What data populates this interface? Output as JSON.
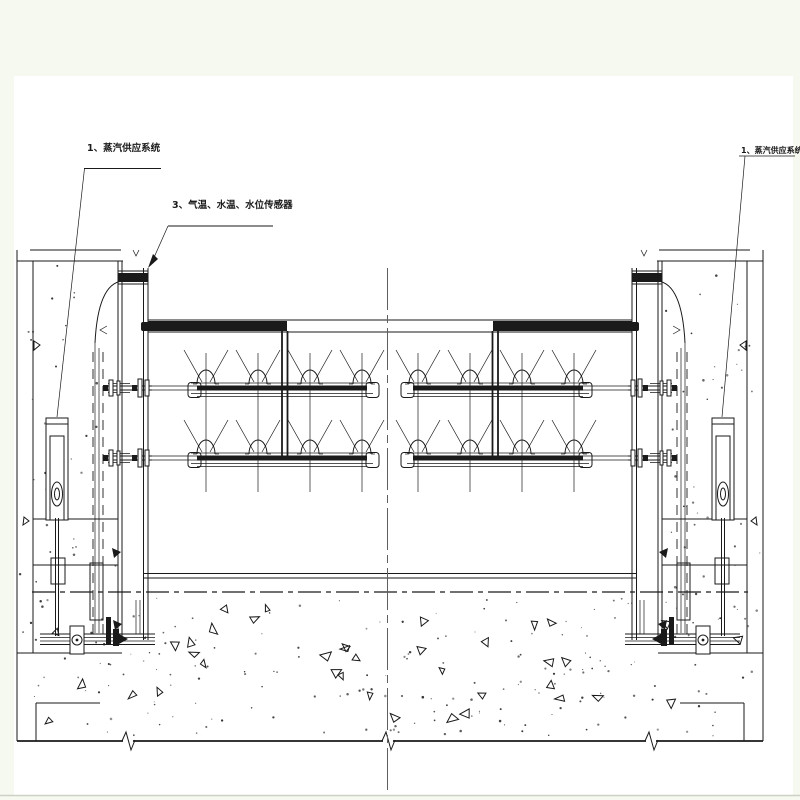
{
  "drawing": {
    "title_context": "gate heating / spray piping section drawing",
    "labels": {
      "steam_supply": "1、蒸汽供应系统",
      "sensors": "3、气温、水温、水位传感器"
    },
    "colors": {
      "line": "#1a1a1a",
      "margin": "#f6f9f0",
      "background": "#ffffff",
      "centerline": "#5f5f5f"
    }
  }
}
